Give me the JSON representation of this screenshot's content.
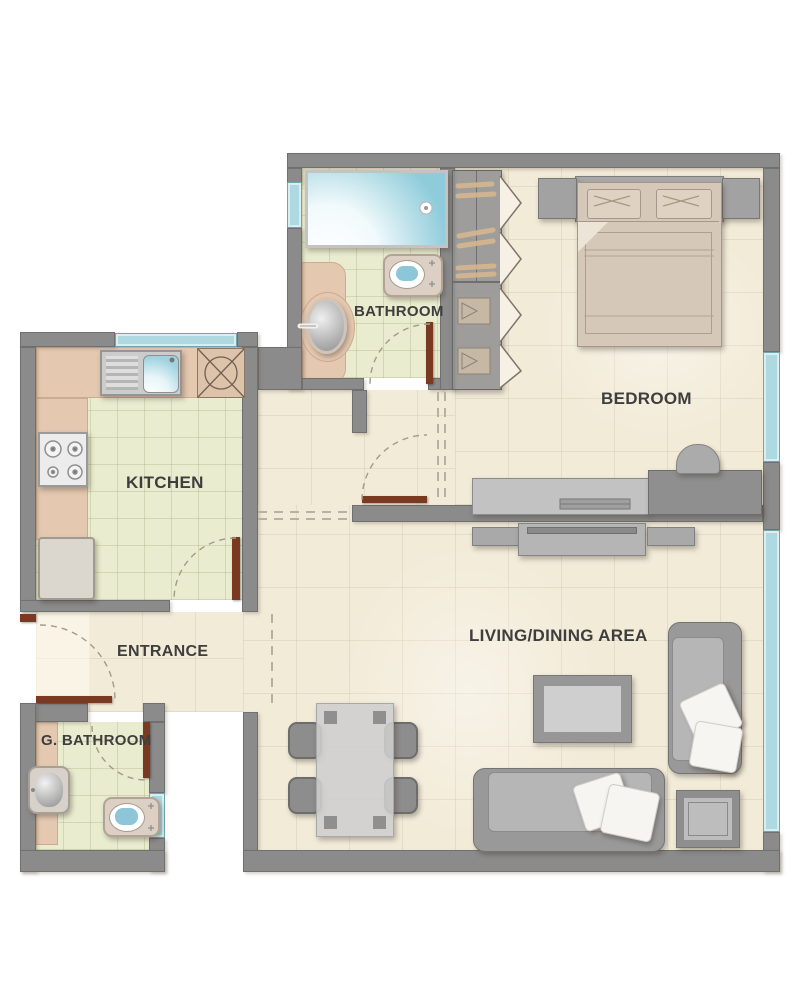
{
  "plan": {
    "title": "Apartment Floor Plan",
    "rooms": {
      "bathroom": {
        "label": "BATHROOM"
      },
      "bedroom": {
        "label": "BEDROOM"
      },
      "kitchen": {
        "label": "KITCHEN"
      },
      "entrance": {
        "label": "ENTRANCE"
      },
      "guest_bathroom": {
        "label": "G. BATHROOM"
      },
      "living_dining": {
        "label": "LIVING/DINING AREA"
      }
    },
    "fixtures": [
      "shower",
      "toilet",
      "vanity-sink",
      "wardrobe",
      "double-bed",
      "pillows",
      "nightstands",
      "desk",
      "desk-chair",
      "kitchen-sink",
      "stove",
      "washing-machine",
      "fridge",
      "dining-table",
      "dining-chairs",
      "coffee-table",
      "sofa",
      "loveseat",
      "side-table",
      "tv-console",
      "guest-sink",
      "guest-toilet"
    ],
    "counts": {
      "windows": 5,
      "doors": 5
    }
  },
  "colors": {
    "wall": "#8b8b8b",
    "wall_edge": "#707070",
    "floor_cream": "#f2ebd8",
    "floor_green": "#e9eccf",
    "counter_pink": "#e4c8b0",
    "window_blue": "#aed9e0",
    "door_brown": "#7a3a22",
    "furniture_gray": "#9c9c9c",
    "bed_tan": "#d5c8b9",
    "label_text": "#3e3e3e"
  }
}
